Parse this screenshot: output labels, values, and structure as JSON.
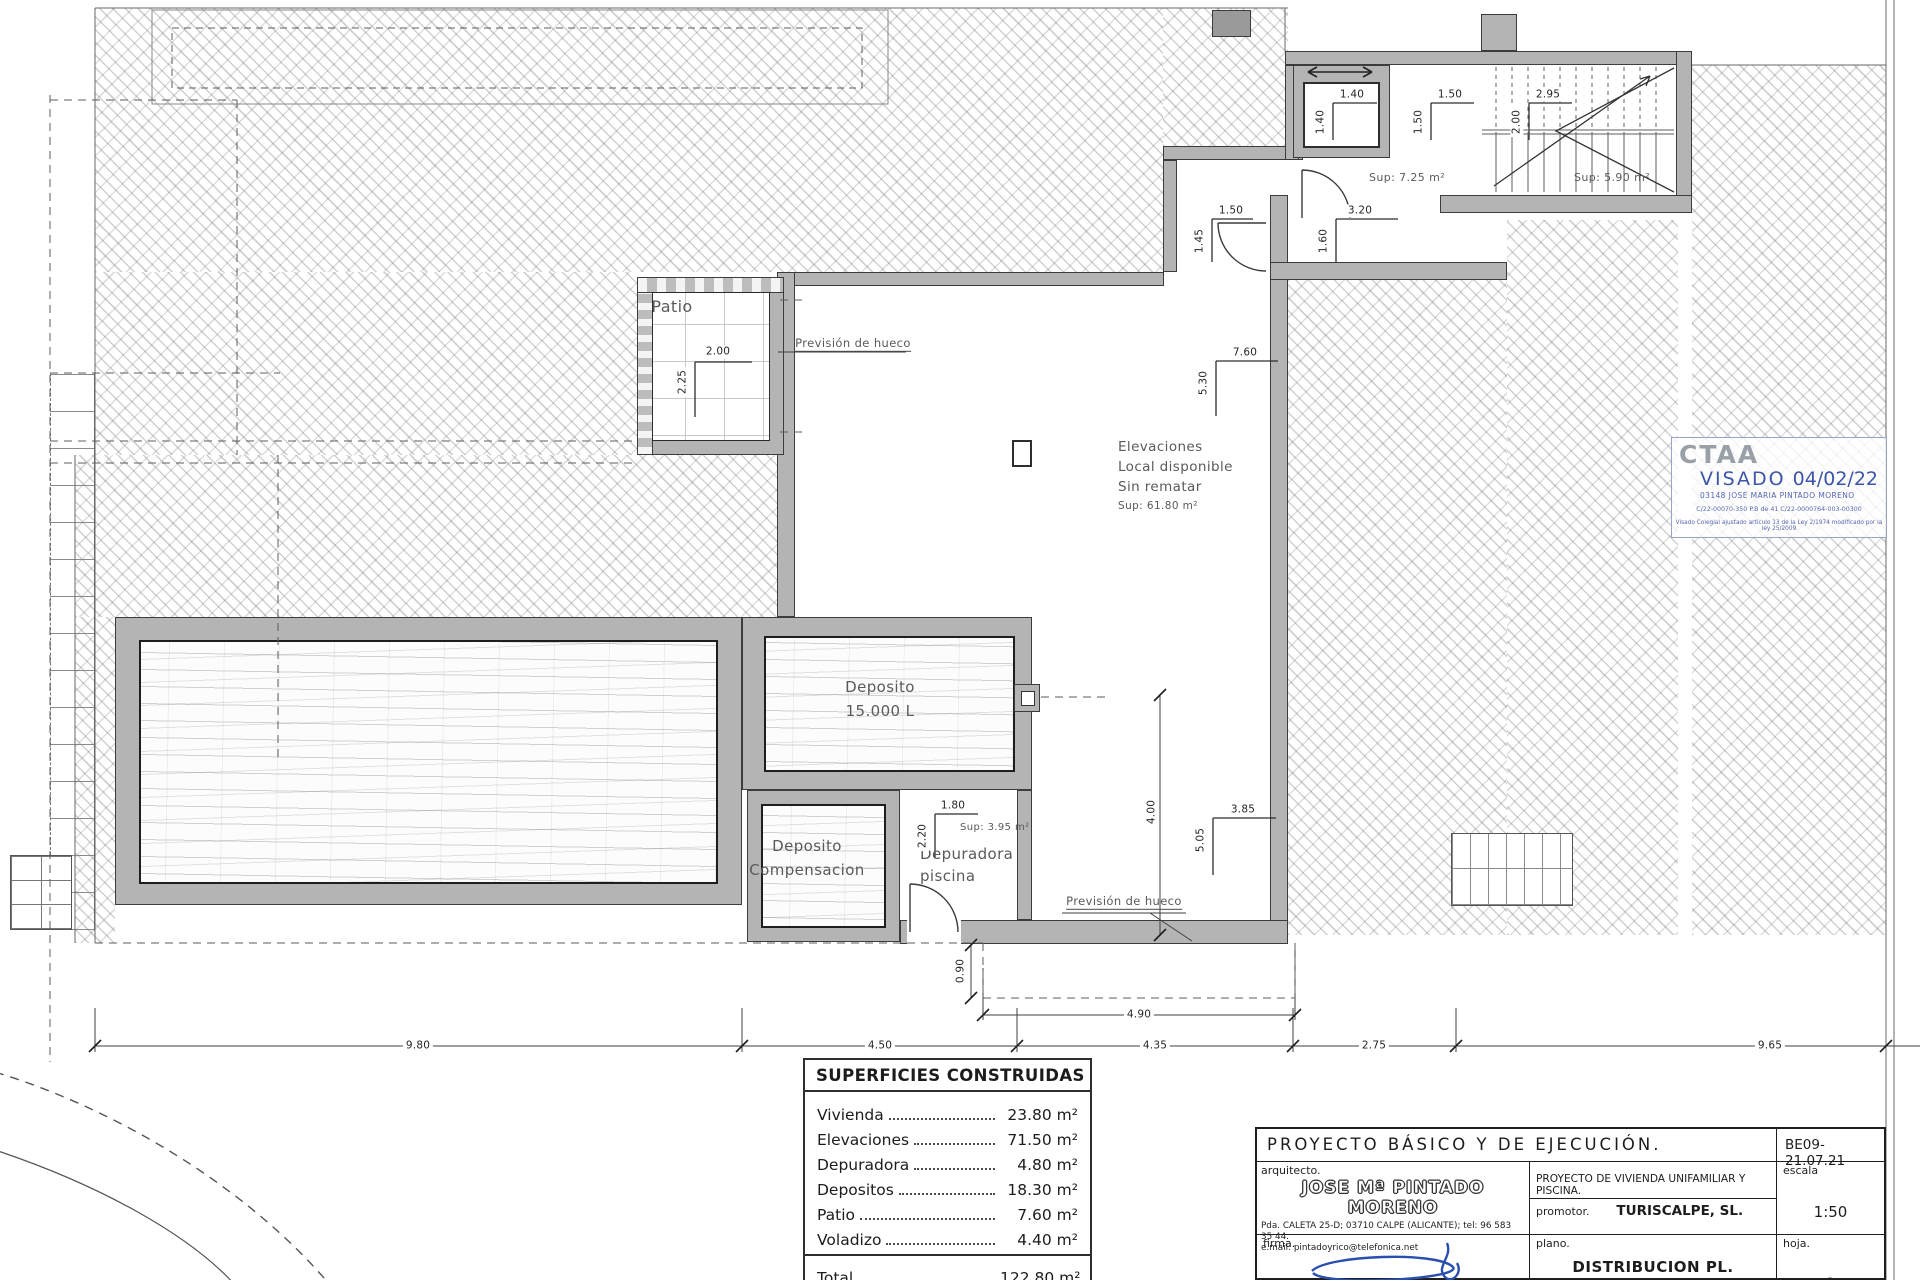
{
  "plan": {
    "labels": [
      {
        "n": "patio-label",
        "t": "Patio",
        "x": 672,
        "y": 307,
        "s": 16
      },
      {
        "n": "prevision-hueco-top-label",
        "t": "Previsión de hueco",
        "x": 853,
        "y": 344,
        "s": 11.5,
        "u": 1
      },
      {
        "n": "local-disponible-label",
        "t": "Elevaciones\nLocal disponible\nSin rematar",
        "x": 1118,
        "y": 437,
        "s": 13.5,
        "a": "tl",
        "lh": 20
      },
      {
        "n": "local-sup-label",
        "t": "Sup: 61.80 m²",
        "x": 1118,
        "y": 500,
        "s": 10.5,
        "a": "tl"
      },
      {
        "n": "deposito-15000-label",
        "t": "Deposito\n15.000 L",
        "x": 880,
        "y": 699,
        "s": 15,
        "lh": 24
      },
      {
        "n": "deposito-compensacion-label",
        "t": "Deposito\nCompensacion",
        "x": 807,
        "y": 858,
        "s": 15,
        "lh": 24
      },
      {
        "n": "depuradora-label",
        "t": "Depuradora\npiscina",
        "x": 920,
        "y": 843,
        "s": 15,
        "a": "tl",
        "lh": 22
      },
      {
        "n": "depuradora-sup-label",
        "t": "Sup: 3.95 m²",
        "x": 960,
        "y": 822,
        "s": 10,
        "a": "tl"
      },
      {
        "n": "landing-sup-label",
        "t": "Sup: 7.25 m²",
        "x": 1407,
        "y": 178,
        "s": 11
      },
      {
        "n": "stairs-sup-label",
        "t": "Sup: 5.90 m²",
        "x": 1612,
        "y": 178,
        "s": 11
      },
      {
        "n": "prevision-hueco-bottom-label",
        "t": "Previsión de hueco",
        "x": 1124,
        "y": 902,
        "s": 11.5,
        "u": 1
      },
      {
        "n": "dim-2-00-patio",
        "t": "2.00",
        "x": 718,
        "y": 352,
        "d": 1
      },
      {
        "n": "dim-2-25-patio",
        "t": "2.25",
        "x": 683,
        "y": 382,
        "d": 1,
        "r": 1
      },
      {
        "n": "dim-1-40-h",
        "t": "1.40",
        "x": 1352,
        "y": 95,
        "d": 1
      },
      {
        "n": "dim-1-40-v",
        "t": "1.40",
        "x": 1321,
        "y": 122,
        "d": 1,
        "r": 1
      },
      {
        "n": "dim-1-50-h",
        "t": "1.50",
        "x": 1450,
        "y": 95,
        "d": 1
      },
      {
        "n": "dim-1-50-v",
        "t": "1.50",
        "x": 1419,
        "y": 122,
        "d": 1,
        "r": 1
      },
      {
        "n": "dim-2-95-h",
        "t": "2.95",
        "x": 1548,
        "y": 95,
        "d": 1
      },
      {
        "n": "dim-2-00-v",
        "t": "2.00",
        "x": 1517,
        "y": 122,
        "d": 1,
        "r": 1
      },
      {
        "n": "dim-1-50-door",
        "t": "1.50",
        "x": 1231,
        "y": 211,
        "d": 1
      },
      {
        "n": "dim-1-45-door",
        "t": "1.45",
        "x": 1200,
        "y": 241,
        "d": 1,
        "r": 1
      },
      {
        "n": "dim-3-20-void",
        "t": "3.20",
        "x": 1360,
        "y": 211,
        "d": 1
      },
      {
        "n": "dim-1-60-void",
        "t": "1.60",
        "x": 1324,
        "y": 241,
        "d": 1,
        "r": 1
      },
      {
        "n": "dim-7-60",
        "t": "7.60",
        "x": 1245,
        "y": 353,
        "d": 1
      },
      {
        "n": "dim-5-30",
        "t": "5.30",
        "x": 1204,
        "y": 383,
        "d": 1,
        "r": 1
      },
      {
        "n": "dim-3-85",
        "t": "3.85",
        "x": 1243,
        "y": 810,
        "d": 1
      },
      {
        "n": "dim-5-05",
        "t": "5.05",
        "x": 1201,
        "y": 840,
        "d": 1,
        "r": 1
      },
      {
        "n": "dim-1-80",
        "t": "1.80",
        "x": 953,
        "y": 806,
        "d": 1
      },
      {
        "n": "dim-2-20",
        "t": "2.20",
        "x": 923,
        "y": 836,
        "d": 1,
        "r": 1
      },
      {
        "n": "dim-4-00",
        "t": "4.00",
        "x": 1152,
        "y": 812,
        "d": 1,
        "r": 1
      },
      {
        "n": "dim-0-90",
        "t": "0.90",
        "x": 961,
        "y": 971,
        "d": 1,
        "r": 1
      },
      {
        "n": "dim-4-90",
        "t": "4.90",
        "x": 1139,
        "y": 1015,
        "d": 1
      },
      {
        "n": "dim-9-80",
        "t": "9.80",
        "x": 418,
        "y": 1046,
        "d": 1
      },
      {
        "n": "dim-4-50",
        "t": "4.50",
        "x": 880,
        "y": 1046,
        "d": 1
      },
      {
        "n": "dim-4-35",
        "t": "4.35",
        "x": 1155,
        "y": 1046,
        "d": 1
      },
      {
        "n": "dim-2-75",
        "t": "2.75",
        "x": 1374,
        "y": 1046,
        "d": 1
      },
      {
        "n": "dim-9-65",
        "t": "9.65",
        "x": 1770,
        "y": 1046,
        "d": 1
      }
    ]
  },
  "areas_table": {
    "title": "SUPERFICIES CONSTRUIDAS",
    "rows": [
      {
        "label": "Vivienda",
        "value": "23.80 m²"
      },
      {
        "label": "Elevaciones",
        "value": "71.50 m²"
      },
      {
        "label": "Depuradora",
        "value": "4.80 m²"
      },
      {
        "label": "Depositos",
        "value": "18.30 m²"
      },
      {
        "label": "Patio",
        "value": "7.60 m²"
      },
      {
        "label": "Voladizo",
        "value": "4.40 m²"
      }
    ],
    "total_label": "Total",
    "total_value": "122.80 m²"
  },
  "title_block": {
    "heading": "PROYECTO  BÁSICO  Y  DE  EJECUCIÓN.",
    "ref_code": "BE09-21.07.21",
    "arquitecto_label": "arquitecto.",
    "arquitecto_name": "JOSE Mª PINTADO MORENO",
    "arquitecto_address": "Pda. CALETA 25-D; 03710 CALPE (ALICANTE); tel: 96 583 35 44.\ne.mail: pintadoyrico@telefonica.net",
    "project_desc": "PROYECTO  DE  VIVIENDA  UNIFAMILIAR  Y  PISCINA.",
    "promotor_label": "promotor.",
    "promotor_name": "TURISCALPE, SL.",
    "escala_label": "escala",
    "escala_value": "1:50",
    "firma_label": "firma.",
    "plano_label": "plano.",
    "plano_name": "DISTRIBUCION  PL.  SEMISOTANO",
    "hoja_label": "hoja.",
    "hoja_value": "2"
  },
  "stamp": {
    "org": "CTAA",
    "visado_label": "VISADO",
    "date": "04/02/22",
    "holder": "03148 JOSE MARIA PINTADO MORENO",
    "ref_line": "C/22-00070-350      P.B de 41      C/22-0000764-003-00300",
    "legal_line": "Visado Colegial ajustado artículo 13 de la Ley 2/1974 modificado por la ley 25/2009"
  },
  "colors": {
    "wall_gray": "#b4b4b4",
    "line_dark": "#3c3c3c",
    "stamp_blue": "#3b55a8",
    "signature_blue": "#2b4fae"
  }
}
